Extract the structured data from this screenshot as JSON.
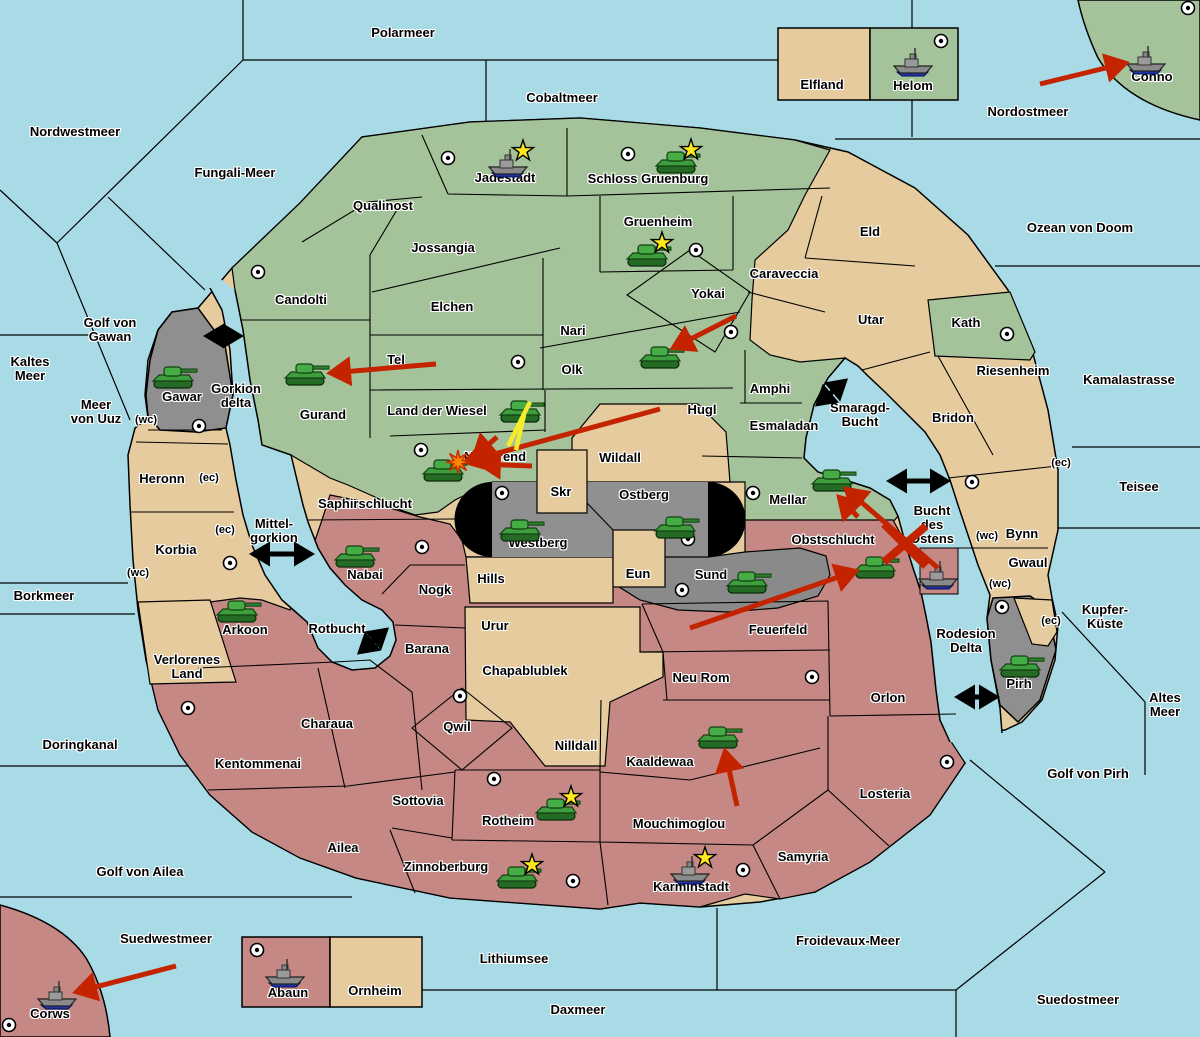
{
  "title": "Fantasy Diplomacy war map",
  "palette": {
    "sea": "#A9DBE7",
    "land_green": "#A5C39A",
    "land_tan": "#E6CB9E",
    "land_red": "#C58885",
    "land_grey": "#8F8F8F",
    "grey_west": "#949494",
    "grey_east": "#888888",
    "capsule_black": "#000000",
    "border": "#000000",
    "arrow_red": "#C42300",
    "arrow_yellow": "#F5EC2E",
    "connector_black": "#000000",
    "star_yellow": "#FFE81C",
    "burst_orange": "#FF8800",
    "tank_green": "#3E9E3E",
    "ship_grey": "#8A8A8A",
    "ship_navy": "#2233AA"
  },
  "labels": [
    {
      "text": "Polarmeer",
      "x": 403,
      "y": 33,
      "kind": "sea"
    },
    {
      "text": "Cobaltmeer",
      "x": 562,
      "y": 98,
      "kind": "sea"
    },
    {
      "text": "Nordwestmeer",
      "x": 75,
      "y": 132,
      "kind": "sea"
    },
    {
      "text": "Fungali-Meer",
      "x": 235,
      "y": 173,
      "kind": "sea"
    },
    {
      "text": "Nordostmeer",
      "x": 1028,
      "y": 112,
      "kind": "sea"
    },
    {
      "text": "Ozean von Doom",
      "x": 1080,
      "y": 228,
      "kind": "sea"
    },
    {
      "text": "Kaltes\nMeer",
      "x": 30,
      "y": 369,
      "kind": "sea"
    },
    {
      "text": "Golf von\nGawan",
      "x": 110,
      "y": 330,
      "kind": "sea"
    },
    {
      "text": "Meer\nvon Uuz",
      "x": 96,
      "y": 412,
      "kind": "sea"
    },
    {
      "text": "Kamalastrasse",
      "x": 1129,
      "y": 380,
      "kind": "sea"
    },
    {
      "text": "Teisee",
      "x": 1139,
      "y": 487,
      "kind": "sea"
    },
    {
      "text": "Borkmeer",
      "x": 44,
      "y": 596,
      "kind": "sea"
    },
    {
      "text": "Kupfer-\nKüste",
      "x": 1105,
      "y": 617,
      "kind": "sea"
    },
    {
      "text": "Altes\nMeer",
      "x": 1165,
      "y": 705,
      "kind": "sea"
    },
    {
      "text": "Golf von Pirh",
      "x": 1088,
      "y": 774,
      "kind": "sea"
    },
    {
      "text": "Doringkanal",
      "x": 80,
      "y": 745,
      "kind": "sea"
    },
    {
      "text": "Golf von Ailea",
      "x": 140,
      "y": 872,
      "kind": "sea"
    },
    {
      "text": "Suedwestmeer",
      "x": 166,
      "y": 939,
      "kind": "sea"
    },
    {
      "text": "Froidevaux-Meer",
      "x": 848,
      "y": 941,
      "kind": "sea"
    },
    {
      "text": "Lithiumsee",
      "x": 514,
      "y": 959,
      "kind": "sea"
    },
    {
      "text": "Daxmeer",
      "x": 578,
      "y": 1010,
      "kind": "sea"
    },
    {
      "text": "Suedostmeer",
      "x": 1078,
      "y": 1000,
      "kind": "sea"
    },
    {
      "text": "Gorkion\ndelta",
      "x": 236,
      "y": 396,
      "kind": "sea"
    },
    {
      "text": "Mittel-\ngorkion",
      "x": 274,
      "y": 531,
      "kind": "sea"
    },
    {
      "text": "Smaragd-\nBucht",
      "x": 860,
      "y": 415,
      "kind": "sea"
    },
    {
      "text": "Bucht\ndes\nOstens",
      "x": 932,
      "y": 525,
      "kind": "sea"
    },
    {
      "text": "Rotbucht",
      "x": 337,
      "y": 629,
      "kind": "sea"
    },
    {
      "text": "Rodesion\nDelta",
      "x": 966,
      "y": 641,
      "kind": "sea"
    },
    {
      "text": "Jadestadt",
      "x": 505,
      "y": 178,
      "kind": "land"
    },
    {
      "text": "Schloss Gruenburg",
      "x": 648,
      "y": 179,
      "kind": "land"
    },
    {
      "text": "Qualinost",
      "x": 383,
      "y": 206,
      "kind": "land"
    },
    {
      "text": "Jossangia",
      "x": 443,
      "y": 248,
      "kind": "land"
    },
    {
      "text": "Gruenheim",
      "x": 658,
      "y": 222,
      "kind": "land"
    },
    {
      "text": "Caraveccia",
      "x": 784,
      "y": 274,
      "kind": "land"
    },
    {
      "text": "Eld",
      "x": 870,
      "y": 232,
      "kind": "land"
    },
    {
      "text": "Elfland",
      "x": 822,
      "y": 85,
      "kind": "land"
    },
    {
      "text": "Helom",
      "x": 913,
      "y": 86,
      "kind": "land"
    },
    {
      "text": "Conno",
      "x": 1152,
      "y": 77,
      "kind": "land"
    },
    {
      "text": "Candolti",
      "x": 301,
      "y": 300,
      "kind": "land"
    },
    {
      "text": "Elchen",
      "x": 452,
      "y": 307,
      "kind": "land"
    },
    {
      "text": "Yokai",
      "x": 708,
      "y": 294,
      "kind": "land"
    },
    {
      "text": "Nari",
      "x": 573,
      "y": 331,
      "kind": "land"
    },
    {
      "text": "Olk",
      "x": 572,
      "y": 370,
      "kind": "land"
    },
    {
      "text": "Utar",
      "x": 871,
      "y": 320,
      "kind": "land"
    },
    {
      "text": "Kath",
      "x": 966,
      "y": 323,
      "kind": "land"
    },
    {
      "text": "Tel",
      "x": 396,
      "y": 360,
      "kind": "land"
    },
    {
      "text": "Gurand",
      "x": 323,
      "y": 415,
      "kind": "land"
    },
    {
      "text": "Land der Wiesel",
      "x": 437,
      "y": 411,
      "kind": "land"
    },
    {
      "text": "Hugl",
      "x": 702,
      "y": 410,
      "kind": "land"
    },
    {
      "text": "Amphi",
      "x": 770,
      "y": 389,
      "kind": "land"
    },
    {
      "text": "Esmaladan",
      "x": 784,
      "y": 426,
      "kind": "land"
    },
    {
      "text": "Bridon",
      "x": 953,
      "y": 418,
      "kind": "land"
    },
    {
      "text": "Riesenheim",
      "x": 1013,
      "y": 371,
      "kind": "land"
    },
    {
      "text": "Gawar",
      "x": 182,
      "y": 397,
      "kind": "land"
    },
    {
      "text": "Heronn",
      "x": 162,
      "y": 479,
      "kind": "land"
    },
    {
      "text": "Korbia",
      "x": 176,
      "y": 550,
      "kind": "land"
    },
    {
      "text": "Saphirschlucht",
      "x": 365,
      "y": 504,
      "kind": "land"
    },
    {
      "text": "Nabai",
      "x": 365,
      "y": 575,
      "kind": "land"
    },
    {
      "text": "Norterend",
      "x": 495,
      "y": 457,
      "kind": "land"
    },
    {
      "text": "Wildall",
      "x": 620,
      "y": 458,
      "kind": "land"
    },
    {
      "text": "Skr",
      "x": 561,
      "y": 492,
      "kind": "land"
    },
    {
      "text": "Ostberg",
      "x": 644,
      "y": 495,
      "kind": "land"
    },
    {
      "text": "Westberg",
      "x": 538,
      "y": 543,
      "kind": "land"
    },
    {
      "text": "Mellar",
      "x": 788,
      "y": 500,
      "kind": "land"
    },
    {
      "text": "Bynn",
      "x": 1022,
      "y": 534,
      "kind": "land"
    },
    {
      "text": "Gwaul",
      "x": 1028,
      "y": 563,
      "kind": "land"
    },
    {
      "text": "Hills",
      "x": 491,
      "y": 579,
      "kind": "land"
    },
    {
      "text": "Eun",
      "x": 638,
      "y": 574,
      "kind": "land"
    },
    {
      "text": "Sund",
      "x": 711,
      "y": 575,
      "kind": "land"
    },
    {
      "text": "Obstschlucht",
      "x": 833,
      "y": 540,
      "kind": "land"
    },
    {
      "text": "Nogk",
      "x": 435,
      "y": 590,
      "kind": "land"
    },
    {
      "text": "Urur",
      "x": 495,
      "y": 626,
      "kind": "land"
    },
    {
      "text": "Feuerfeld",
      "x": 778,
      "y": 630,
      "kind": "land"
    },
    {
      "text": "Barana",
      "x": 427,
      "y": 649,
      "kind": "land"
    },
    {
      "text": "Chapablublek",
      "x": 525,
      "y": 671,
      "kind": "land"
    },
    {
      "text": "Neu Rom",
      "x": 701,
      "y": 678,
      "kind": "land"
    },
    {
      "text": "Orlon",
      "x": 888,
      "y": 698,
      "kind": "land"
    },
    {
      "text": "Pirh",
      "x": 1019,
      "y": 684,
      "kind": "land"
    },
    {
      "text": "Verlorenes\nLand",
      "x": 187,
      "y": 667,
      "kind": "land"
    },
    {
      "text": "Charaua",
      "x": 327,
      "y": 724,
      "kind": "land"
    },
    {
      "text": "Qwil",
      "x": 457,
      "y": 727,
      "kind": "land"
    },
    {
      "text": "Nilldall",
      "x": 576,
      "y": 746,
      "kind": "land"
    },
    {
      "text": "Kaaldewaa",
      "x": 660,
      "y": 762,
      "kind": "land"
    },
    {
      "text": "Kentommenai",
      "x": 258,
      "y": 764,
      "kind": "land"
    },
    {
      "text": "Sottovia",
      "x": 418,
      "y": 801,
      "kind": "land"
    },
    {
      "text": "Rotheim",
      "x": 508,
      "y": 821,
      "kind": "land"
    },
    {
      "text": "Mouchimoglou",
      "x": 679,
      "y": 824,
      "kind": "land"
    },
    {
      "text": "Losteria",
      "x": 885,
      "y": 794,
      "kind": "land"
    },
    {
      "text": "Ailea",
      "x": 343,
      "y": 848,
      "kind": "land"
    },
    {
      "text": "Zinnoberburg",
      "x": 446,
      "y": 867,
      "kind": "land"
    },
    {
      "text": "Karminstadt",
      "x": 691,
      "y": 887,
      "kind": "land"
    },
    {
      "text": "Samyria",
      "x": 803,
      "y": 857,
      "kind": "land"
    },
    {
      "text": "Abaun",
      "x": 288,
      "y": 993,
      "kind": "land"
    },
    {
      "text": "Ornheim",
      "x": 375,
      "y": 991,
      "kind": "land"
    },
    {
      "text": "Corws",
      "x": 50,
      "y": 1014,
      "kind": "land"
    },
    {
      "text": "(wc)",
      "x": 146,
      "y": 421,
      "kind": "small"
    },
    {
      "text": "(ec)",
      "x": 209,
      "y": 479,
      "kind": "small"
    },
    {
      "text": "(ec)",
      "x": 225,
      "y": 531,
      "kind": "small"
    },
    {
      "text": "(wc)",
      "x": 138,
      "y": 574,
      "kind": "small"
    },
    {
      "text": "(ec)",
      "x": 1061,
      "y": 464,
      "kind": "small"
    },
    {
      "text": "(wc)",
      "x": 987,
      "y": 537,
      "kind": "small"
    },
    {
      "text": "(wc)",
      "x": 1000,
      "y": 585,
      "kind": "small"
    },
    {
      "text": "(ec)",
      "x": 1051,
      "y": 622,
      "kind": "small"
    }
  ],
  "supply_centers": [
    {
      "territory": "Candolti",
      "x": 258,
      "y": 272
    },
    {
      "territory": "Jadestadt",
      "x": 448,
      "y": 158
    },
    {
      "territory": "Schloss Gruenburg",
      "x": 628,
      "y": 154
    },
    {
      "territory": "Gruenheim",
      "x": 696,
      "y": 250
    },
    {
      "territory": "Helom",
      "x": 941,
      "y": 41
    },
    {
      "territory": "Conno",
      "x": 1188,
      "y": 8
    },
    {
      "territory": "Yokai",
      "x": 731,
      "y": 332
    },
    {
      "territory": "Olk",
      "x": 518,
      "y": 362
    },
    {
      "territory": "Norterend",
      "x": 421,
      "y": 450
    },
    {
      "territory": "Kath",
      "x": 1007,
      "y": 334
    },
    {
      "territory": "Bridon",
      "x": 972,
      "y": 482
    },
    {
      "territory": "Gawar",
      "x": 199,
      "y": 426
    },
    {
      "territory": "Korbia",
      "x": 230,
      "y": 563
    },
    {
      "territory": "Westberg",
      "x": 502,
      "y": 493
    },
    {
      "territory": "Ostberg",
      "x": 688,
      "y": 539
    },
    {
      "territory": "Sund",
      "x": 682,
      "y": 590
    },
    {
      "territory": "Mellar",
      "x": 753,
      "y": 493
    },
    {
      "territory": "Nabai",
      "x": 422,
      "y": 547
    },
    {
      "territory": "Qwil",
      "x": 460,
      "y": 696
    },
    {
      "territory": "Rotheim",
      "x": 494,
      "y": 779
    },
    {
      "territory": "Kentommenai",
      "x": 188,
      "y": 708
    },
    {
      "territory": "Zinnoberburg",
      "x": 573,
      "y": 881
    },
    {
      "territory": "Karminstadt",
      "x": 743,
      "y": 870
    },
    {
      "territory": "Losteria",
      "x": 947,
      "y": 762
    },
    {
      "territory": "Neu Rom",
      "x": 812,
      "y": 677
    },
    {
      "territory": "Pirh",
      "x": 1002,
      "y": 607
    },
    {
      "territory": "Abaun",
      "x": 257,
      "y": 950
    },
    {
      "territory": "Corws",
      "x": 9,
      "y": 1025
    }
  ],
  "units": [
    {
      "type": "fleet",
      "territory": "Jadestadt",
      "x": 508,
      "y": 165,
      "star": true
    },
    {
      "type": "army",
      "territory": "Schloss Gruenburg",
      "x": 676,
      "y": 164,
      "star": true
    },
    {
      "type": "army",
      "territory": "Gruenheim",
      "x": 647,
      "y": 257,
      "star": true
    },
    {
      "type": "fleet",
      "territory": "Helom",
      "x": 913,
      "y": 64,
      "star": false
    },
    {
      "type": "fleet",
      "territory": "Conno",
      "x": 1146,
      "y": 62,
      "star": false
    },
    {
      "type": "army",
      "territory": "Gawar",
      "x": 173,
      "y": 379,
      "star": false
    },
    {
      "type": "army",
      "territory": "Gurand",
      "x": 305,
      "y": 376,
      "star": false
    },
    {
      "type": "army",
      "territory": "Yokai",
      "x": 660,
      "y": 359,
      "star": false
    },
    {
      "type": "army",
      "territory": "Land der Wiesel",
      "x": 520,
      "y": 413,
      "star": false
    },
    {
      "type": "army",
      "territory": "Norterend",
      "x": 443,
      "y": 472,
      "star": false
    },
    {
      "type": "army",
      "territory": "Westberg",
      "x": 520,
      "y": 532,
      "star": false
    },
    {
      "type": "army",
      "territory": "Ostberg",
      "x": 675,
      "y": 529,
      "star": false
    },
    {
      "type": "army",
      "territory": "Mellar",
      "x": 832,
      "y": 482,
      "star": false
    },
    {
      "type": "army",
      "territory": "Obstschlucht",
      "x": 875,
      "y": 569,
      "star": false
    },
    {
      "type": "fleet",
      "territory": "Bucht des Ostens",
      "x": 938,
      "y": 577,
      "star": false
    },
    {
      "type": "army",
      "territory": "Sund",
      "x": 747,
      "y": 584,
      "star": false
    },
    {
      "type": "army",
      "territory": "Nabai",
      "x": 355,
      "y": 558,
      "star": false
    },
    {
      "type": "army",
      "territory": "Arkoon",
      "x": 237,
      "y": 613,
      "star": false
    },
    {
      "type": "army",
      "territory": "Pirh",
      "x": 1020,
      "y": 668,
      "star": false
    },
    {
      "type": "army",
      "territory": "Kaaldewaa",
      "x": 718,
      "y": 739,
      "star": false
    },
    {
      "type": "army",
      "territory": "Rotheim",
      "x": 556,
      "y": 811,
      "star": true
    },
    {
      "type": "army",
      "territory": "Zinnoberburg",
      "x": 517,
      "y": 879,
      "star": true
    },
    {
      "type": "fleet",
      "territory": "Karminstadt",
      "x": 690,
      "y": 872,
      "star": true
    },
    {
      "type": "fleet",
      "territory": "Abaun",
      "x": 285,
      "y": 975,
      "star": false
    },
    {
      "type": "fleet",
      "territory": "Corws",
      "x": 57,
      "y": 997,
      "star": false
    }
  ],
  "extra_land_labels_note": "Arkoon label",
  "arkoon_label": {
    "text": "Arkoon",
    "x": 245,
    "y": 630
  },
  "attack_arrows": [
    {
      "x1": 1040,
      "y1": 84,
      "x2": 1126,
      "y2": 63,
      "target": "Conno"
    },
    {
      "x1": 436,
      "y1": 364,
      "x2": 330,
      "y2": 373,
      "target": "Gurand"
    },
    {
      "x1": 736,
      "y1": 316,
      "x2": 673,
      "y2": 348,
      "target": "Yokai"
    },
    {
      "x1": 660,
      "y1": 409,
      "x2": 465,
      "y2": 462,
      "target": "Norterend"
    },
    {
      "x1": 497,
      "y1": 437,
      "x2": 474,
      "y2": 457,
      "target": "Norterend"
    },
    {
      "x1": 532,
      "y1": 466,
      "x2": 480,
      "y2": 464,
      "target": "Norterend"
    },
    {
      "x1": 938,
      "y1": 568,
      "x2": 846,
      "y2": 489,
      "target": "Mellar"
    },
    {
      "x1": 858,
      "y1": 517,
      "x2": 839,
      "y2": 497,
      "target": "Mellar"
    },
    {
      "x1": 690,
      "y1": 628,
      "x2": 856,
      "y2": 571,
      "target": "Obstschlucht"
    },
    {
      "x1": 737,
      "y1": 806,
      "x2": 725,
      "y2": 751,
      "target": "Kaaldewaa"
    },
    {
      "x1": 176,
      "y1": 966,
      "x2": 76,
      "y2": 992,
      "target": "Corws"
    }
  ],
  "support_arrows": [
    {
      "x1": 530,
      "y1": 402,
      "x2": 508,
      "y2": 446
    },
    {
      "x1": 524,
      "y1": 415,
      "x2": 516,
      "y2": 450
    }
  ],
  "strait_connectors": [
    {
      "x1": 207,
      "y1": 336,
      "x2": 240,
      "y2": 336,
      "name": "Gorkion delta crossing"
    },
    {
      "x1": 253,
      "y1": 554,
      "x2": 311,
      "y2": 554,
      "name": "Mittel-gorkion crossing"
    },
    {
      "x1": 818,
      "y1": 404,
      "x2": 845,
      "y2": 381,
      "name": "Smaragd-Bucht crossing"
    },
    {
      "x1": 890,
      "y1": 481,
      "x2": 947,
      "y2": 481,
      "name": "Bucht des Ostens crossing"
    },
    {
      "x1": 360,
      "y1": 652,
      "x2": 386,
      "y2": 630,
      "name": "Rotbucht crossing"
    },
    {
      "x1": 958,
      "y1": 697,
      "x2": 996,
      "y2": 697,
      "name": "Rodesion Delta crossing"
    }
  ],
  "cut_crosses": [
    {
      "x": 905,
      "y": 544
    }
  ],
  "explosions": [
    {
      "x": 458,
      "y": 462
    }
  ],
  "sea_box": {
    "x": 920,
    "y": 548,
    "w": 38,
    "h": 46,
    "name": "convoy square"
  }
}
